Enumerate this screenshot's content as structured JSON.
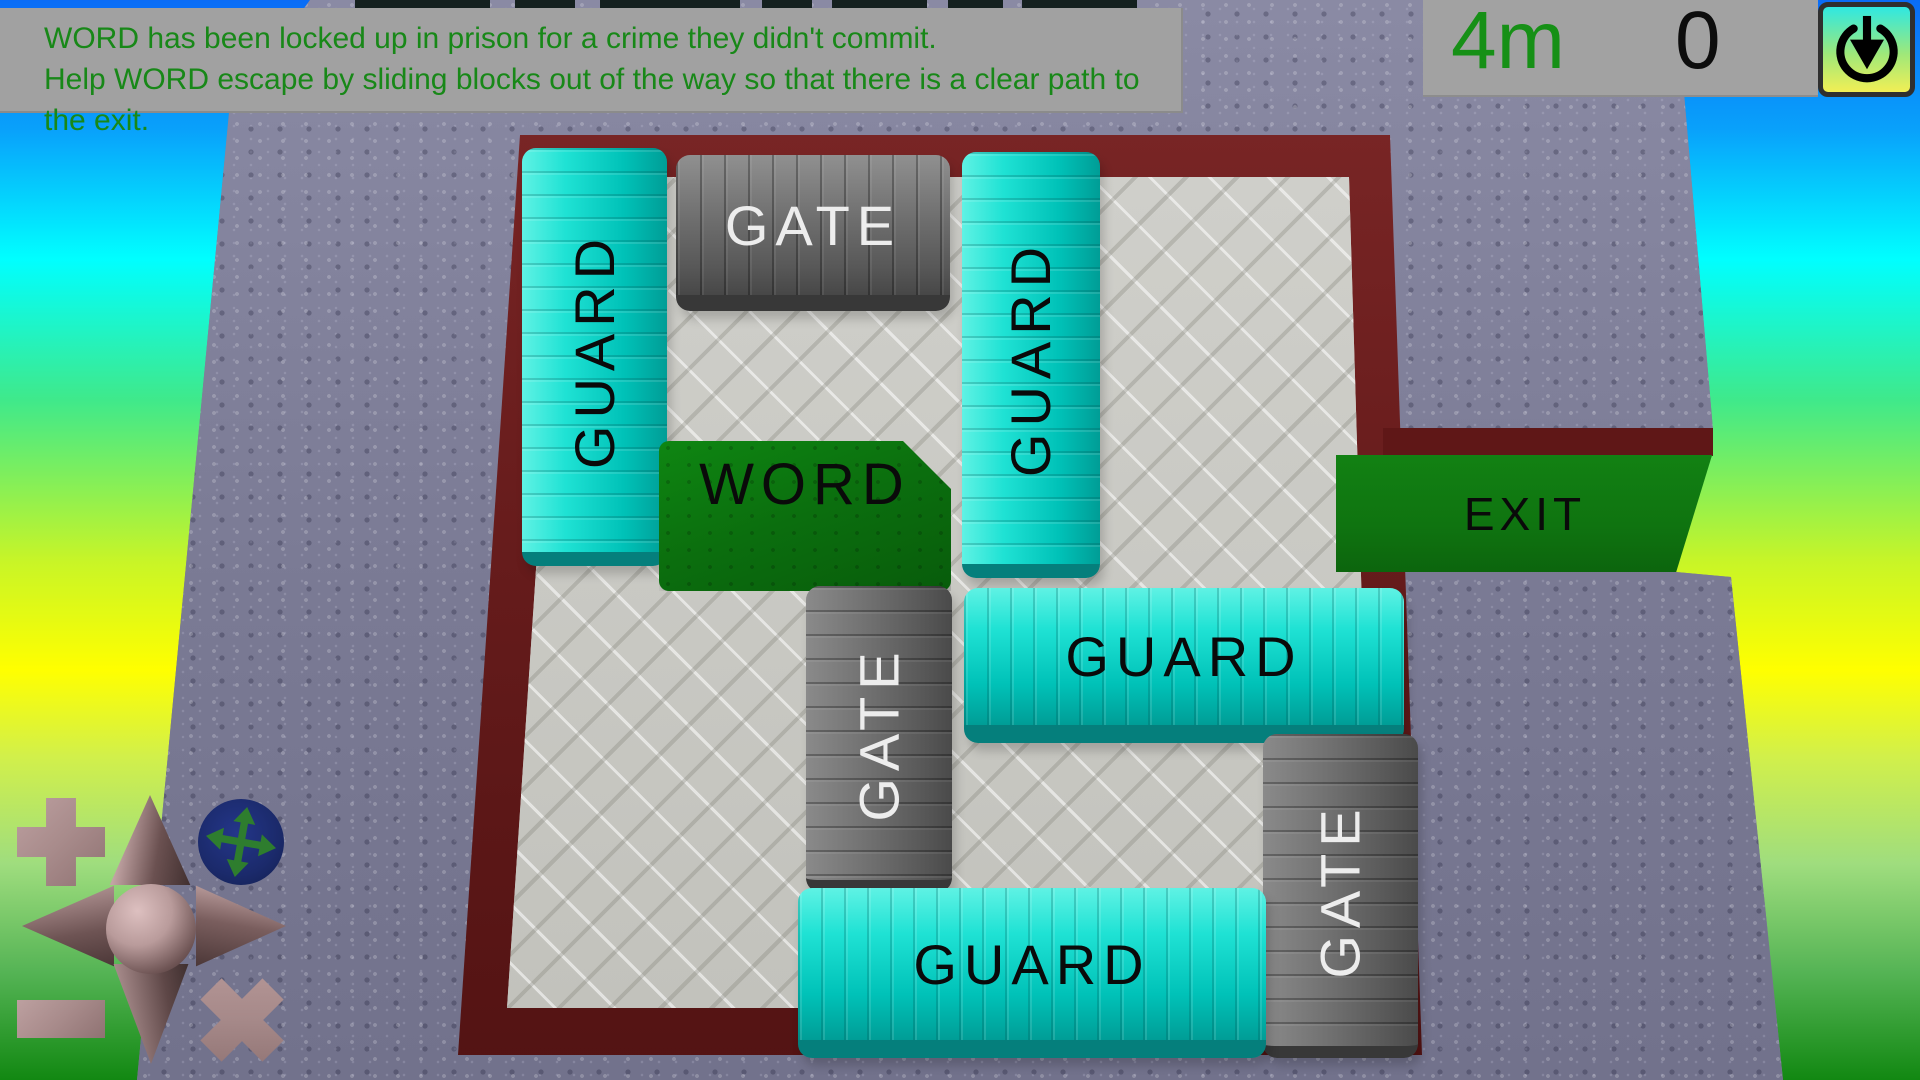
{
  "instructions": {
    "line1": "WORD has been locked up in prison for a crime they didn't commit.",
    "line2": "Help WORD escape by sliding blocks out of the way so that there is a clear path to the exit."
  },
  "hud": {
    "timer": "4m",
    "moves": "0",
    "restart_icon": "power-restart-down-arrow-icon"
  },
  "board": {
    "exit_label": "EXIT",
    "blocks": [
      {
        "id": "guard-left",
        "label": "GUARD",
        "type": "guard",
        "orientation": "vertical"
      },
      {
        "id": "gate-top",
        "label": "GATE",
        "type": "gate",
        "orientation": "horizontal"
      },
      {
        "id": "guard-center-top",
        "label": "GUARD",
        "type": "guard",
        "orientation": "vertical"
      },
      {
        "id": "word-prisoner",
        "label": "WORD",
        "type": "word",
        "orientation": "horizontal"
      },
      {
        "id": "guard-middle-right",
        "label": "GUARD",
        "type": "guard",
        "orientation": "horizontal"
      },
      {
        "id": "gate-middle",
        "label": "GATE",
        "type": "gate",
        "orientation": "vertical"
      },
      {
        "id": "gate-bottom-right",
        "label": "GATE",
        "type": "gate",
        "orientation": "vertical"
      },
      {
        "id": "guard-bottom",
        "label": "GUARD",
        "type": "guard",
        "orientation": "horizontal"
      }
    ]
  },
  "controls": {
    "zoom_in": "plus-icon",
    "zoom_out": "minus-icon",
    "pan": "four-way-pan-arrows-icon",
    "dpad": "compass-dpad-arrows",
    "close": "x-icon"
  },
  "colors": {
    "guard_block": "#10d8cb",
    "gate_block": "#6f6f6f",
    "word_block": "#0b6e0e",
    "exit_floor": "#0f7410",
    "prison_wall": "#6b1e1e",
    "floor": "#c9c9c4",
    "platform": "#7c7c96",
    "timer_text": "#169016",
    "instruction_text": "#188818"
  }
}
